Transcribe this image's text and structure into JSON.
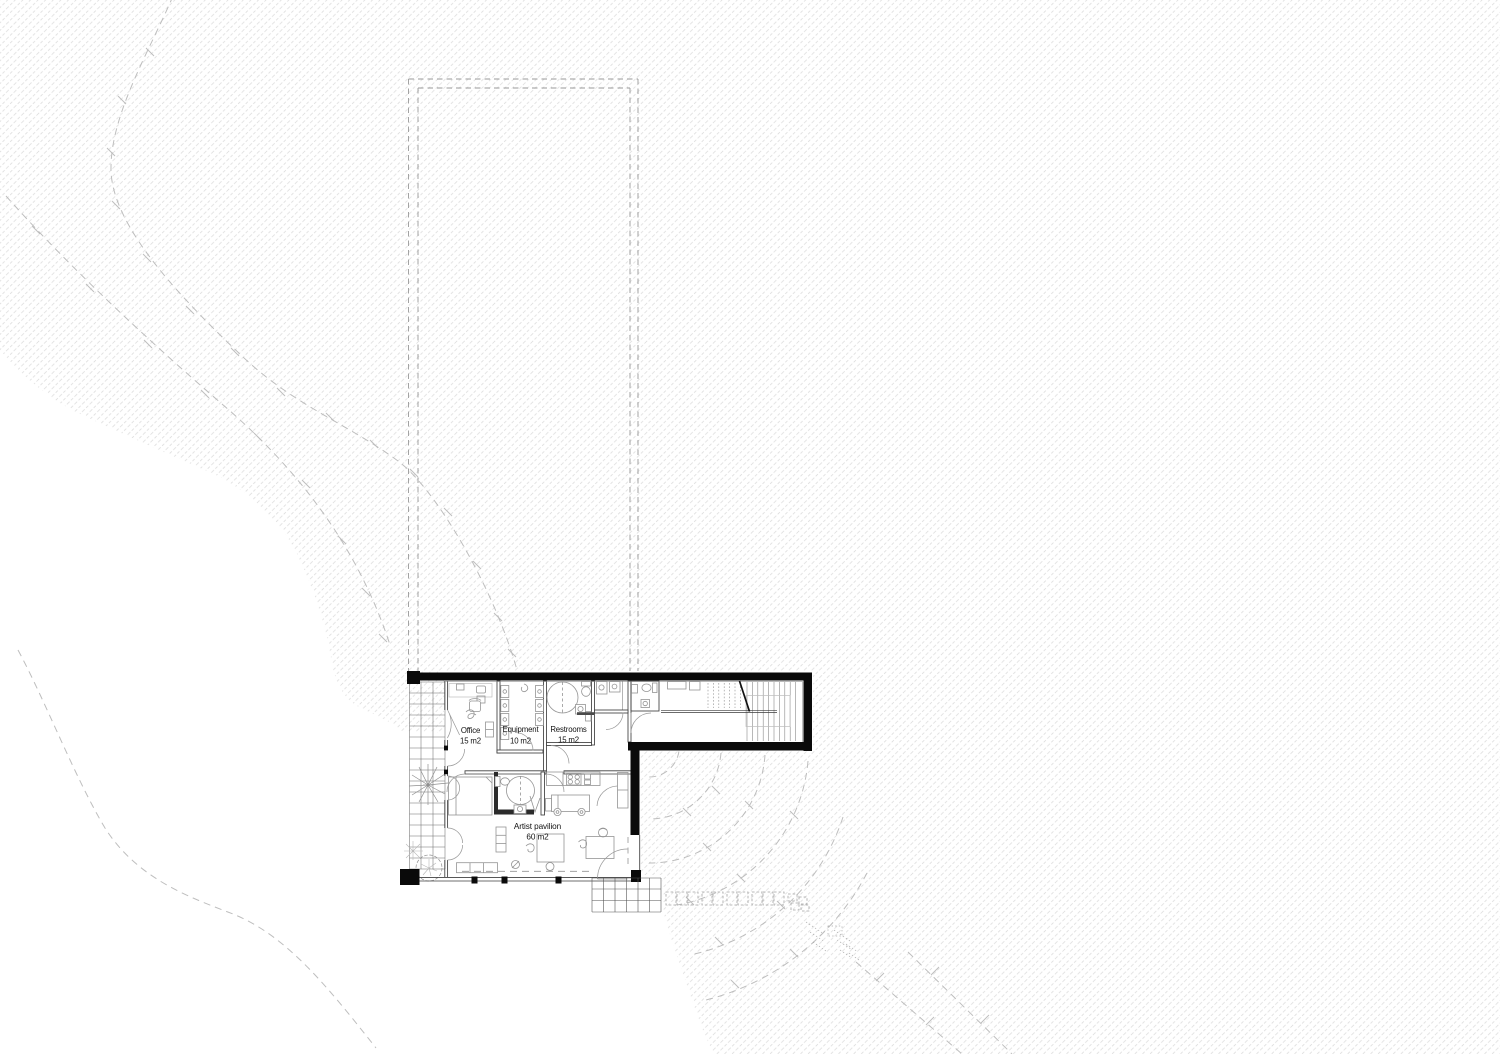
{
  "drawing": {
    "type": "architectural-floor-plan",
    "rooms": [
      {
        "name": "Office",
        "area": "15 m2"
      },
      {
        "name": "Equipment",
        "area": "10 m2"
      },
      {
        "name": "Restrooms",
        "area": "15 m2"
      },
      {
        "name": "Artist pavilion",
        "area": "60 m2"
      }
    ],
    "colors": {
      "wall": "#0a0a0a",
      "line": "#3f3f3f",
      "furniture": "#949494",
      "contour": "#b7b7b7",
      "dashed_outline": "#9a9a9a",
      "background": "#ffffff",
      "label": "#111111"
    }
  }
}
